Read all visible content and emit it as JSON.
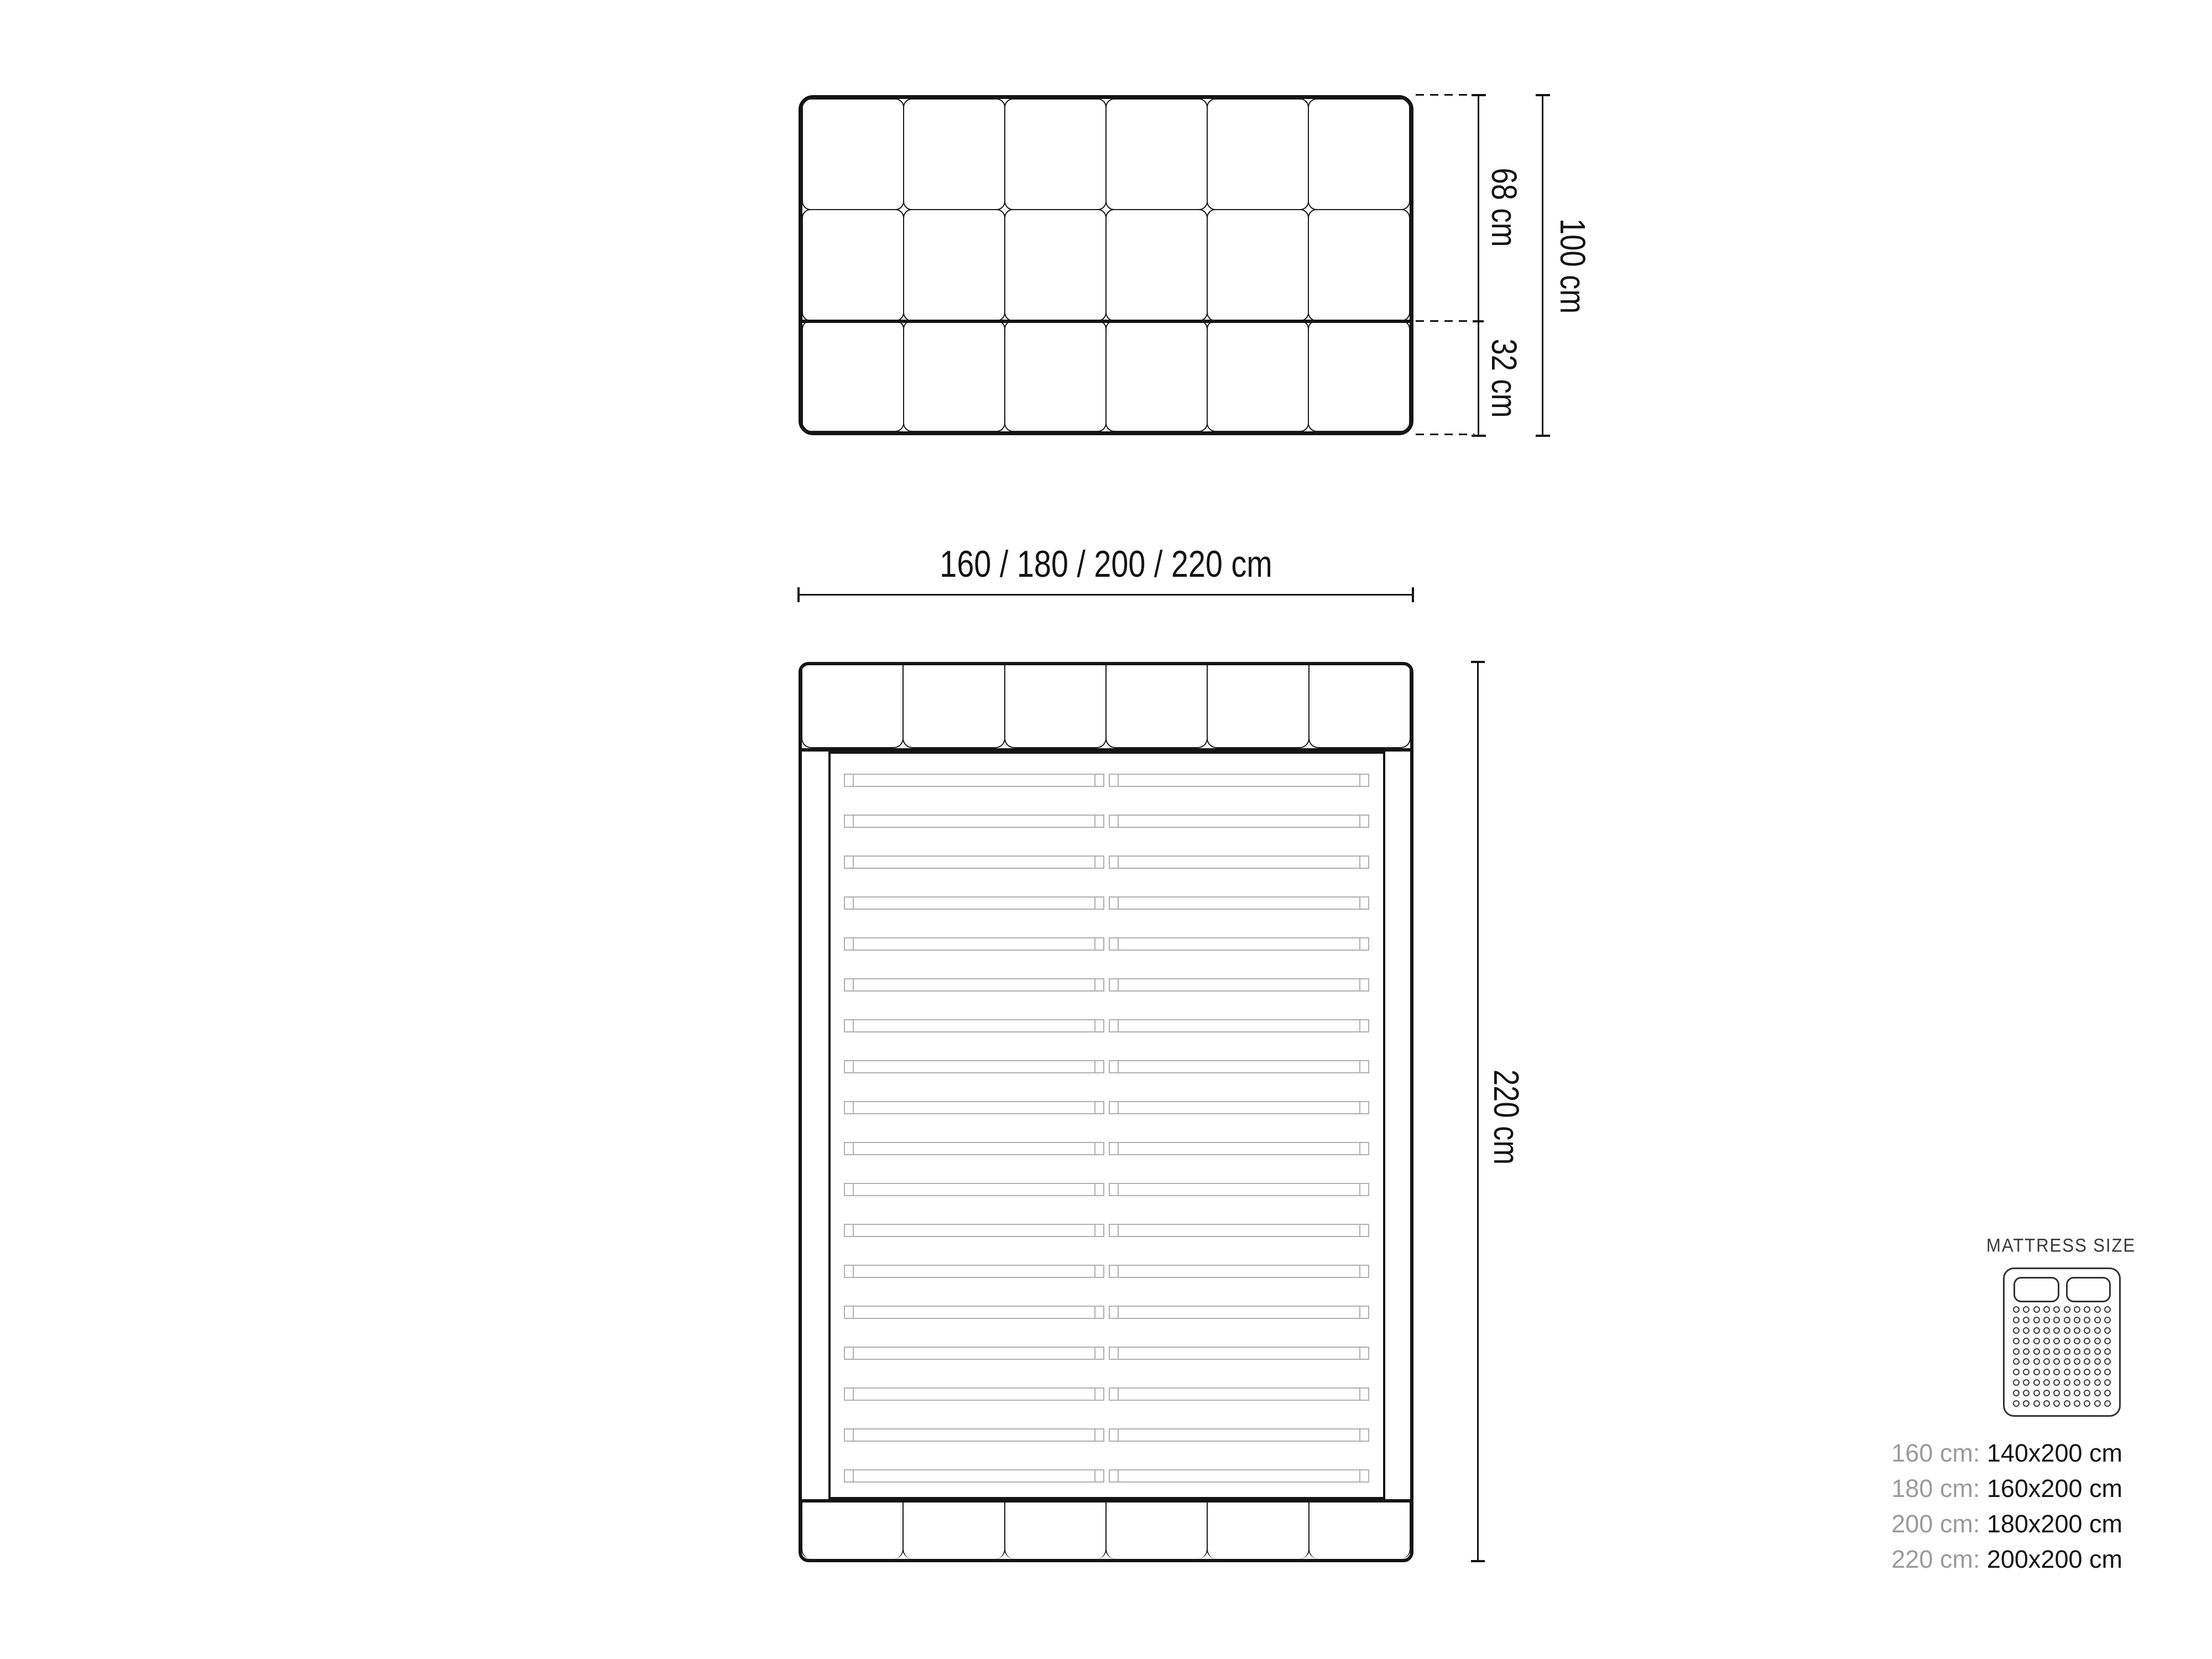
{
  "drawing": {
    "front_view": {
      "grid_columns": 6,
      "grid_rows": 3,
      "dim_upper": "68 cm",
      "dim_lower": "32 cm",
      "dim_total": "100 cm"
    },
    "width_dimension": {
      "label": "160 / 180 / 200 / 220 cm"
    },
    "plan_view": {
      "headboard_segments": 6,
      "footboard_segments": 6,
      "slat_rows": 18,
      "dim_height": "220 cm"
    },
    "legend": {
      "title": "MATTRESS SIZE",
      "dot_rows": 10,
      "dot_columns": 10,
      "rows": [
        {
          "frame": "160 cm:",
          "mattress": "140x200 cm"
        },
        {
          "frame": "180 cm:",
          "mattress": "160x200 cm"
        },
        {
          "frame": "200 cm:",
          "mattress": "180x200 cm"
        },
        {
          "frame": "220 cm:",
          "mattress": "200x200 cm"
        }
      ]
    },
    "colors": {
      "line": "#141414",
      "slat": "#b0b0b0",
      "muted_text": "#9b9b9b",
      "legend_outline": "#333333",
      "background": "#ffffff"
    }
  }
}
